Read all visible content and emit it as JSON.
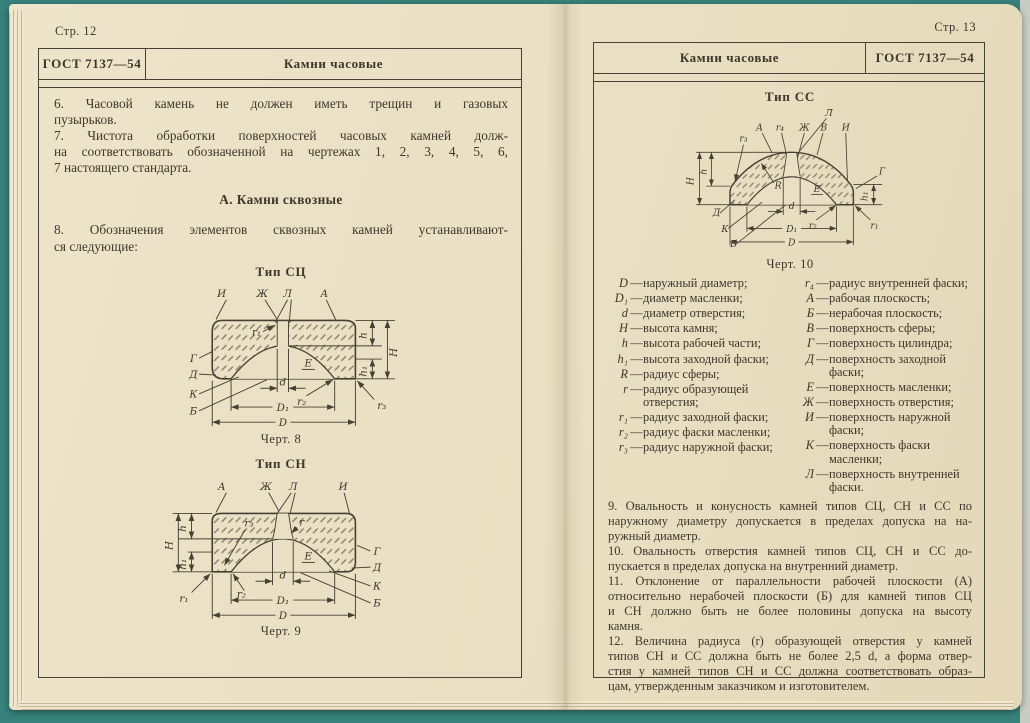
{
  "palette": {
    "scanner_bg": "#37827c",
    "paper": "#e9dfc2",
    "ink": "#3e372b",
    "line": "#474034"
  },
  "left_page": {
    "page_label": "Стр. 12",
    "header": {
      "gost": "ГОСТ 7137—54",
      "title": "Камни часовые"
    },
    "paragraphs": {
      "p6": [
        {
          "t": "6. Часовой  камень не должен иметь  трещин  и газовых"
        },
        {
          "t": "пузырьков."
        }
      ],
      "p7": [
        {
          "t": "7. Чистота обработки поверхностей часовых камней долж-"
        },
        {
          "t": "на соответствовать обозначенной на чертежах 1, 2, 3, 4, 5, 6,"
        },
        {
          "t": "7 настоящего стандарта."
        }
      ],
      "p8": [
        {
          "t": "8. Обозначения элементов сквозных камней устанавливают-"
        },
        {
          "t": "ся следующие:"
        }
      ]
    },
    "section_heading": "А. Камни сквозные",
    "fig8": {
      "title": "Тип СЦ",
      "caption": "Черт. 8",
      "labels": {
        "top": [
          "И",
          "Ж",
          "Л",
          "А"
        ],
        "inner": [
          "r₁",
          "Е"
        ],
        "left": [
          "Г",
          "Д",
          "К",
          "Б"
        ],
        "right": [
          "h",
          "H",
          "h₁",
          "r₃"
        ],
        "bottom": [
          "d",
          "r₂",
          "D₁",
          "D"
        ]
      }
    },
    "fig9": {
      "title": "Тип СН",
      "caption": "Черт. 9",
      "labels": {
        "top": [
          "А",
          "Ж",
          "Л",
          "И"
        ],
        "inner": [
          "r₃",
          "r",
          "Е"
        ],
        "left": [
          "H",
          "h",
          "h₁",
          "r₁"
        ],
        "right": [
          "Г",
          "Д",
          "К",
          "Б"
        ],
        "bottom": [
          "r₂",
          "d",
          "D₁",
          "D"
        ]
      }
    }
  },
  "right_page": {
    "page_label": "Стр. 13",
    "header": {
      "title": "Камни часовые",
      "gost": "ГОСТ 7137—54"
    },
    "fig10": {
      "title": "Тип СС",
      "caption": "Черт. 10",
      "labels": {
        "top": [
          "Л",
          "А",
          "r₄",
          "Ж",
          "В",
          "И"
        ],
        "inner": [
          "r₃",
          "R",
          "Е"
        ],
        "left": [
          "H",
          "h"
        ],
        "right": [
          "Г",
          "h₁",
          "r₁"
        ],
        "lower_left": [
          "Д",
          "К",
          "Б"
        ],
        "bottom": [
          "d",
          "r₂",
          "D₁",
          "D"
        ]
      }
    },
    "legend": {
      "dash": "—",
      "left": [
        {
          "s": "D",
          "t": "наружный диаметр;"
        },
        {
          "s": "D₁",
          "t": "диаметр масленки;"
        },
        {
          "s": "d",
          "t": "диаметр отверстия;"
        },
        {
          "s": "H",
          "t": "высота камня;"
        },
        {
          "s": "h",
          "t": "высота рабочей части;"
        },
        {
          "s": "h₁",
          "t": "высота заходной фаски;"
        },
        {
          "s": "R",
          "t": "радиус сферы;"
        },
        {
          "s": "r",
          "t": "радиус образующей отверстия;"
        },
        {
          "s": "r₁",
          "t": "радиус заходной фаски;"
        },
        {
          "s": "r₂",
          "t": "радиус фаски масленки;"
        },
        {
          "s": "r₃",
          "t": "радиус наружной фаски;"
        }
      ],
      "right": [
        {
          "s": "r₄",
          "t": "радиус внутренней фаски;"
        },
        {
          "s": "А",
          "t": "рабочая плоскость;"
        },
        {
          "s": "Б",
          "t": "нерабочая плоскость;"
        },
        {
          "s": "В",
          "t": "поверхность сферы;"
        },
        {
          "s": "Г",
          "t": "поверхность цилиндра;"
        },
        {
          "s": "Д",
          "t": "поверхность заходной фаски;"
        },
        {
          "s": "Е",
          "t": "поверхность масленки;"
        },
        {
          "s": "Ж",
          "t": "поверхность отверстия;"
        },
        {
          "s": "И",
          "t": "поверхность наружной фаски;"
        },
        {
          "s": "К",
          "t": "поверхность фаски масленки;"
        },
        {
          "s": "Л",
          "t": "поверхность внутренней фаски."
        }
      ]
    },
    "paragraphs": {
      "p9": [
        {
          "t": "9. Овальность и конусность камней типов СЦ, СН и СС по"
        },
        {
          "t": "наружному диаметру допускается в пределах допуска на на-"
        },
        {
          "t": "ружный диаметр."
        }
      ],
      "p10": [
        {
          "t": "10. Овальность отверстия камней типов СЦ, СН и СС до-"
        },
        {
          "t": "пускается в пределах допуска на внутренний диаметр."
        }
      ],
      "p11": [
        {
          "t": "11. Отклонение от параллельности рабочей плоскости (А)"
        },
        {
          "t": "относительно нерабочей плоскости (Б) для камней типов СЦ"
        },
        {
          "t": "и СН должно быть  не более половины  допуска на высоту"
        },
        {
          "t": "камня."
        }
      ],
      "p12": [
        {
          "t": "12. Величина радиуса (r) образующей отверстия у камней"
        },
        {
          "t": "типов СН и СС должна быть не более 2,5 d, а форма отвер-"
        },
        {
          "t": "стия у камней типов СН и СС должна соответствовать образ-"
        },
        {
          "t": "цам, утвержденным заказчиком и изготовителем."
        }
      ]
    }
  }
}
